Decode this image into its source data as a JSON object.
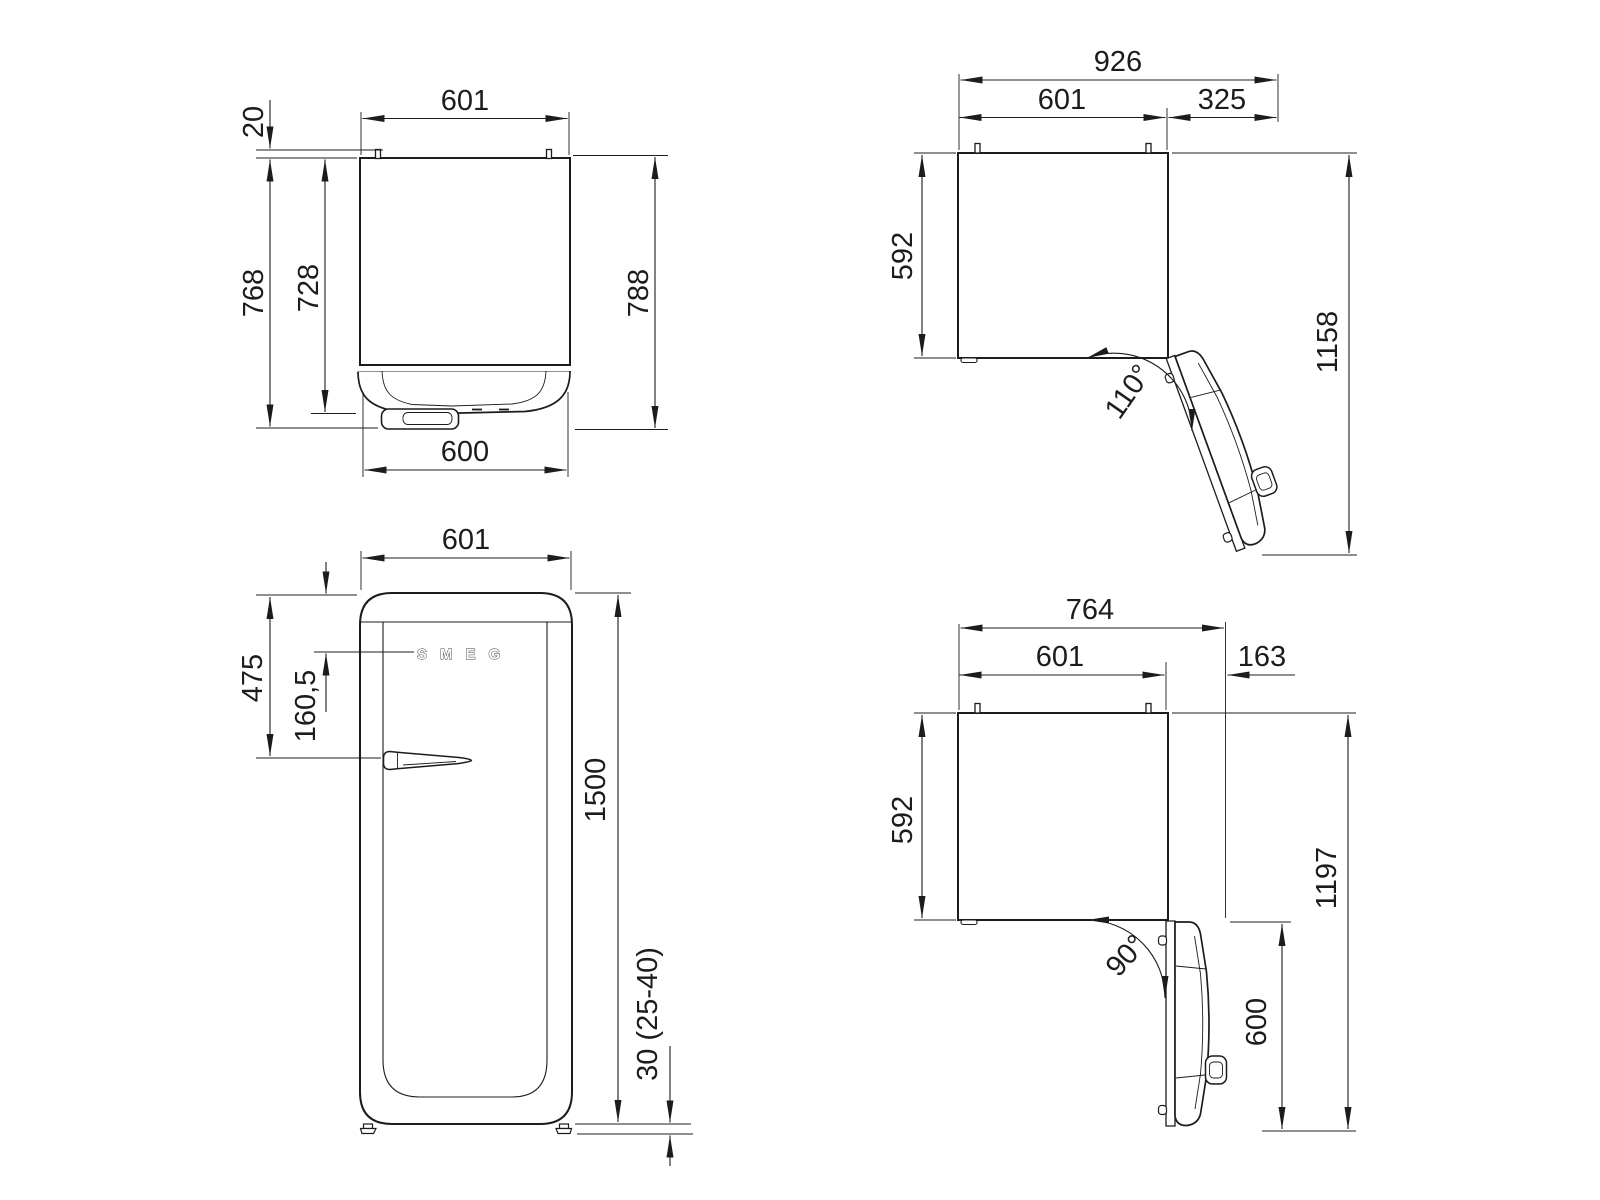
{
  "views": {
    "top_closed": {
      "dims": {
        "width_top": "601",
        "hinge_protrusion": "20",
        "depth_to_handle": "768",
        "depth_to_door_face": "728",
        "depth_overall": "788",
        "door_width": "600"
      }
    },
    "top_open_110": {
      "dims": {
        "overall_width": "926",
        "body_width": "601",
        "side_clearance": "325",
        "body_depth": "592",
        "overall_depth": "1158",
        "door_angle": "110°"
      }
    },
    "front": {
      "brand": "SMEG",
      "dims": {
        "width": "601",
        "top_to_handle": "475",
        "top_to_logo": "160,5",
        "height": "1500",
        "feet_height": "30 (25-40)"
      }
    },
    "top_open_90": {
      "dims": {
        "overall_width": "764",
        "body_width": "601",
        "side_clearance": "163",
        "body_depth": "592",
        "overall_depth": "1197",
        "door_depth_open": "600",
        "door_angle": "90°"
      }
    }
  },
  "colors": {
    "line": "#1c1c1c",
    "background": "#ffffff"
  }
}
